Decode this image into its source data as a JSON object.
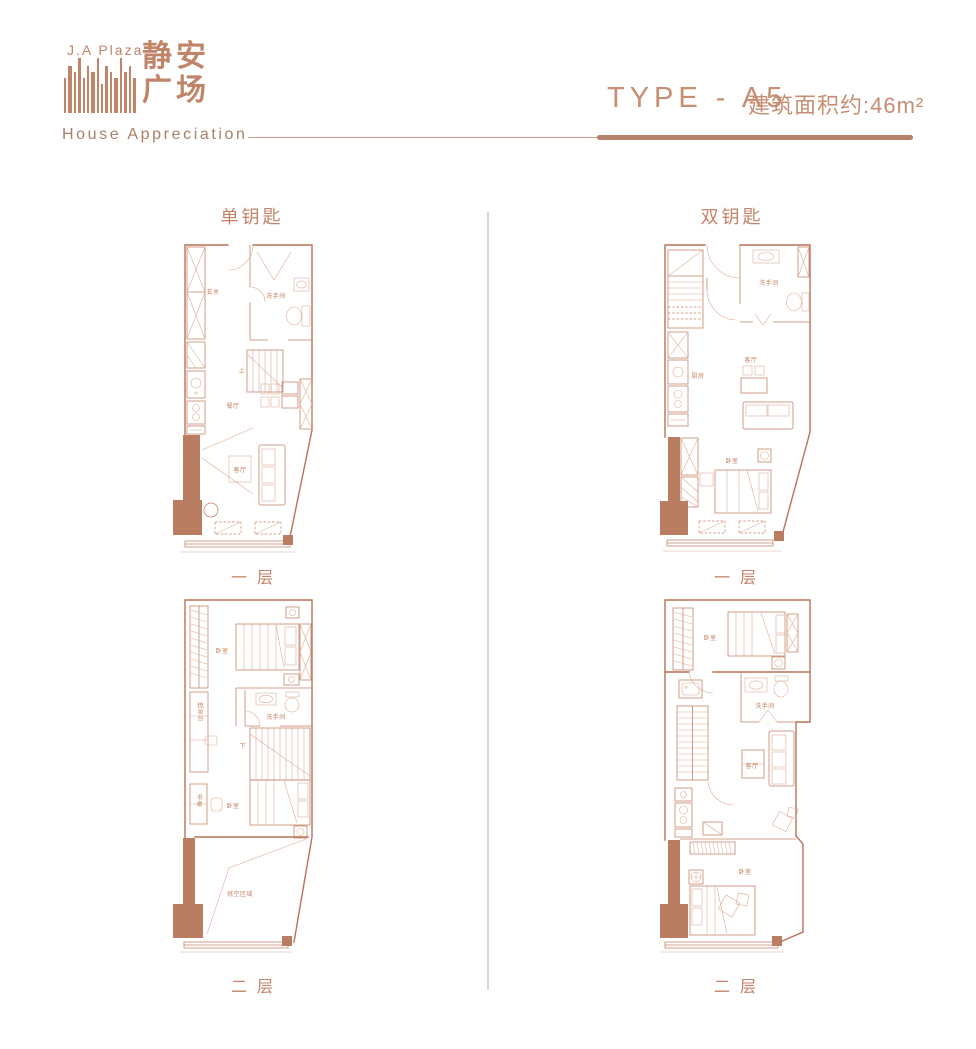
{
  "header": {
    "brand_en": "J.A Plaza",
    "brand_cn_1": "静安",
    "brand_cn_2": "广场",
    "tagline": "House Appreciation",
    "type_label": "TYPE - A5",
    "area_label": "建筑面积约:46m²"
  },
  "sections": {
    "left_title": "单钥匙",
    "right_title": "双钥匙",
    "floor_one": "一层",
    "floor_two": "二层"
  },
  "rooms": {
    "entrance": "玄关",
    "bathroom": "洗手间",
    "dining": "餐厅",
    "living": "客厅",
    "kitchen": "厨房",
    "bedroom": "卧室",
    "up": "上",
    "down": "下",
    "dressing": "梳妆台",
    "desk": "书桌",
    "void": "挑空区域"
  },
  "colors": {
    "accent": "#c08468",
    "plan_wall": "#b97257",
    "plan_light": "#dcae97",
    "plan_fill": "#b97e62",
    "divider": "#dbd6ce"
  }
}
